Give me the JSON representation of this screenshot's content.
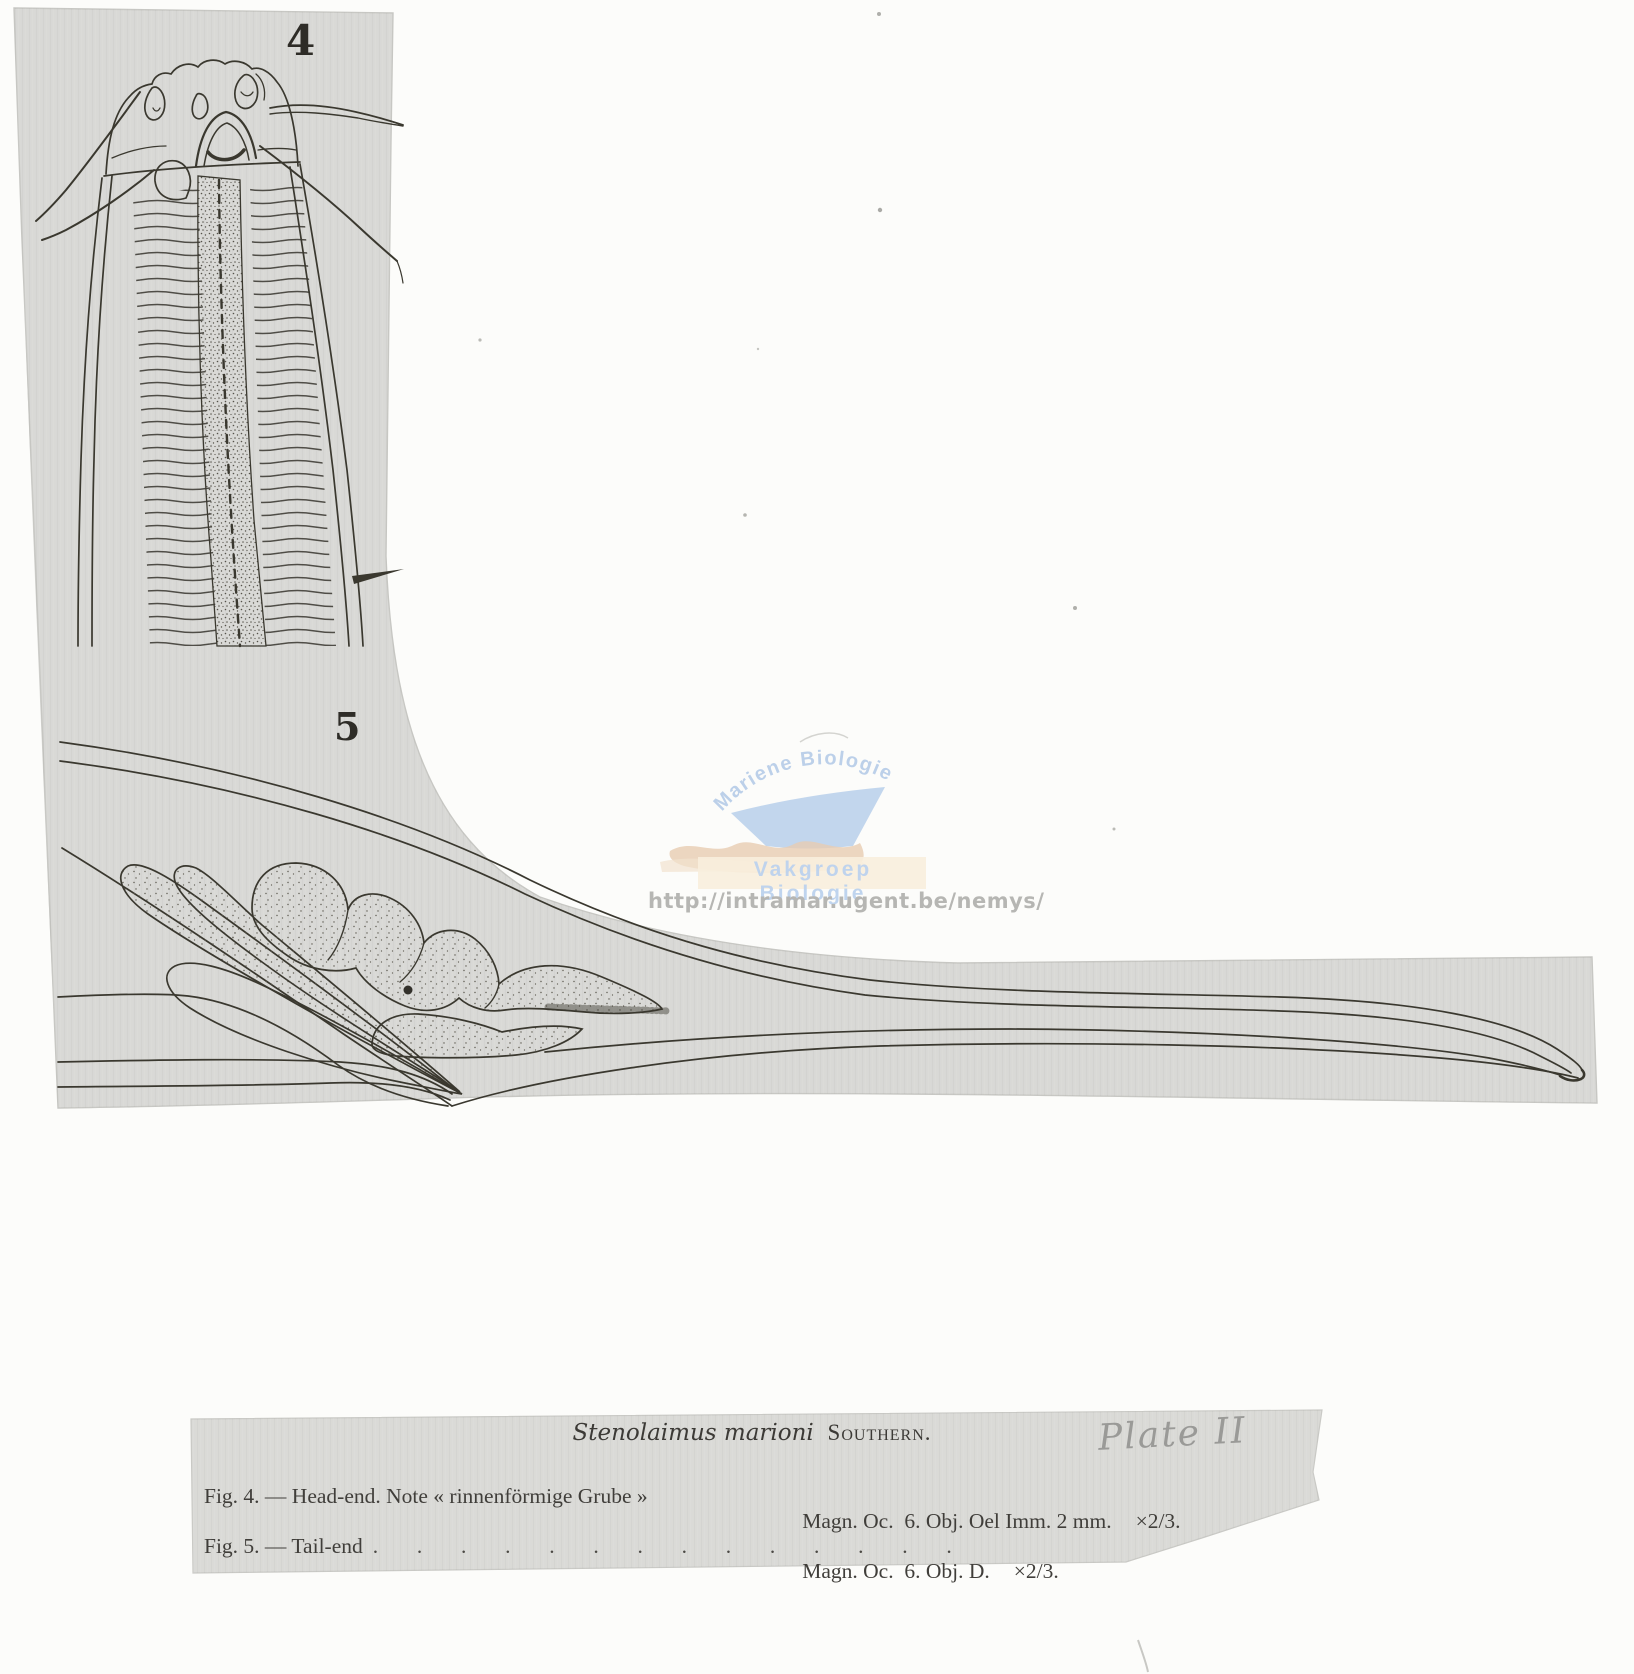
{
  "plate": {
    "figure4_label": "4",
    "figure5_label": "5"
  },
  "watermark": {
    "arc_text": "Mariene Biologie",
    "band_text": "Vakgroep Biologie",
    "url": "http://intramar.ugent.be/nemys/",
    "colors": {
      "blue": "#b9cee9",
      "tan": "#e7ccb1",
      "band": "#f8eedd",
      "url_gray": "#b6b6b3"
    }
  },
  "caption": {
    "species_italic": "Stenolaimus marioni",
    "author_smallcaps": "Southern.",
    "handwritten_note": "Plate II",
    "rows": [
      {
        "label": "Fig. 4. — Head-end. Note « rinnenförmige Grube »",
        "dots": "",
        "magnification": "Magn. Oc.  6. Obj. Oel Imm. 2 mm.",
        "scale": "×2/3."
      },
      {
        "label": "Fig. 5. — Tail-end",
        "dots": ".  .  .  .  .  .  .  .  .  .  .  .  .  .",
        "magnification": "Magn. Oc.  6. Obj. D.",
        "scale": "×2/3."
      }
    ]
  },
  "colors": {
    "paper_gray": "#d9d9d6",
    "ink": "#38362f"
  }
}
